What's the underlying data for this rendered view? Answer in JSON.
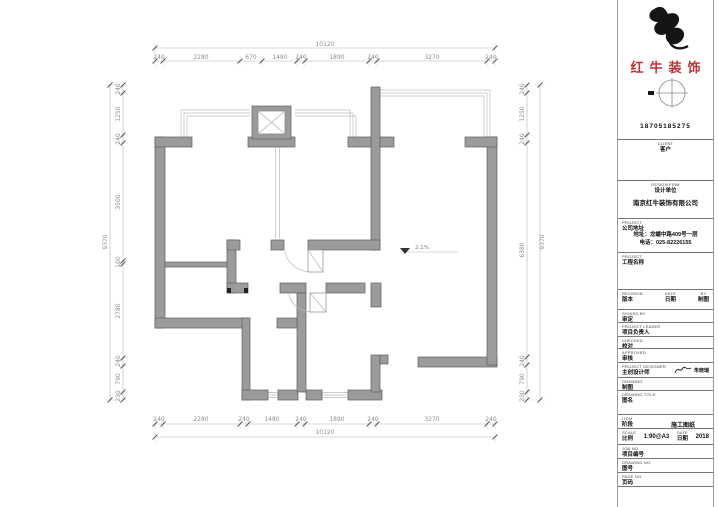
{
  "brand": {
    "name": "红牛装饰",
    "phone": "18705185275",
    "color": "#c03030"
  },
  "title_block": {
    "client": {
      "en": "CLIENT",
      "zh": "客户"
    },
    "design_firm": {
      "en": "DESIGN FIRM",
      "zh": "设计单位",
      "company": "南京红牛装饰有限公司"
    },
    "address": {
      "en": "PROJECT",
      "zh": "公司地址",
      "line1": "地址：龙蟠中路409号一层",
      "line2": "电话：025-82226155"
    },
    "project_name": {
      "en": "PROJECT",
      "zh": "工程名称"
    },
    "revision": {
      "en": "REVISION",
      "zh": "版本"
    },
    "rev_date": {
      "en": "DATE",
      "zh": "日期"
    },
    "rev_by": {
      "en": "BY",
      "zh": "制图"
    },
    "signed_by": {
      "en": "SIGNED BY",
      "zh": "审定"
    },
    "project_leader": {
      "en": "PROJECT LEADER",
      "zh": "项目负责人"
    },
    "checked": {
      "en": "CHECKED",
      "zh": "校对"
    },
    "approved": {
      "en": "APPROVED",
      "zh": "审核"
    },
    "designer": {
      "en": "PROJECT DESIGNER",
      "zh": "主创设计师",
      "signature": "朱晓瑞"
    },
    "drawing": {
      "en": "DRAWING",
      "zh": "制图"
    },
    "drawing_title": {
      "en": "DRAWING TITLE",
      "zh": "图名"
    },
    "item": {
      "en": "ITEM",
      "zh": "阶段",
      "value": "施工图纸"
    },
    "scale": {
      "en": "SCALE",
      "zh": "比例",
      "value": "1:90@A3"
    },
    "date": {
      "en": "DATE",
      "zh": "日期",
      "value": "2018"
    },
    "job_no": {
      "en": "JOB NO.",
      "zh": "项目编号"
    },
    "drawing_no": {
      "en": "DRAWING NO.",
      "zh": "图号"
    },
    "page_no": {
      "en": "PAGE NO.",
      "zh": "页码"
    }
  },
  "plan": {
    "level_marker": "2.1%",
    "dims": {
      "top_total": "10120",
      "top": [
        "240",
        "2280",
        "670",
        "1480",
        "240",
        "1890",
        "240",
        "3270",
        "240"
      ],
      "bottom_total": "10120",
      "bottom": [
        "240",
        "2280",
        "240",
        "1480",
        "240",
        "1890",
        "240",
        "3270",
        "240"
      ],
      "left_total": "9370",
      "left": [
        "240",
        "1250",
        "240",
        "3500",
        "100",
        "2780",
        "240",
        "790",
        "230"
      ],
      "right_total": "9370",
      "right": [
        "240",
        "1250",
        "240",
        "6380",
        "240",
        "790",
        "230"
      ]
    }
  }
}
